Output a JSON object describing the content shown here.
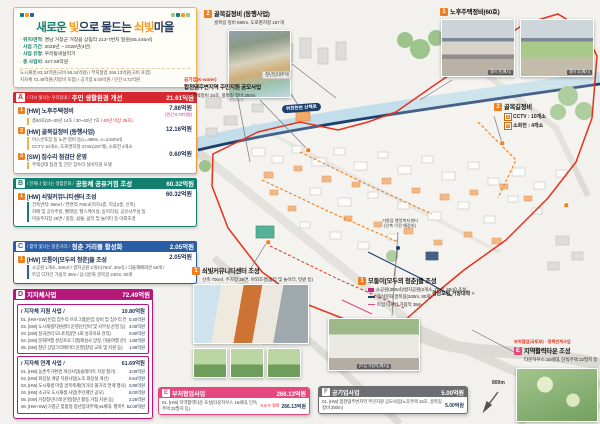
{
  "theme": {
    "accent_orange": "#f07f1e",
    "alert_red": "#e8301a",
    "teal": "#13806f",
    "blue": "#2b5ea7",
    "magenta": "#b5177a",
    "pink": "#e5477e",
    "navy": "#1d2f50",
    "gray": "#6d6e71",
    "river_blue": "#c2deea"
  },
  "title_box": {
    "title_parts": {
      "p1": "새로운 ",
      "p2": "빛",
      "p3": "으로 물드는 ",
      "p4": "쇠빛",
      "p5": "마을"
    },
    "info": [
      {
        "label": "위치/면적",
        "value": ": 경남 거창군 거창읍 상림리 213-7번지 일원(65,445㎡)"
      },
      {
        "label": "사업 기간",
        "value": ": 2025년 ~ 2028년(4년)"
      },
      {
        "label": "사업 유형",
        "value": ": 우리동네살리기"
      },
      {
        "label": "총 사업비",
        "value": ": 427.68억원"
      }
    ],
    "note1": "도시재생 83.34억원(국비 58.34억원) / 부처협업 266.13억원(국비 포함)",
    "note2": "지자체 72.49억원(지방비 포함) / 공기업 5.00억원 / 민간 0.72억원"
  },
  "sections": {
    "A": {
      "badge": "A",
      "tagline": "/ 다시 빛나는 우리동네 /",
      "title": "주민 생활환경 개선",
      "total": "21.61억원",
      "items": [
        {
          "no": "1",
          "title": "[HW] 노후주택정비",
          "amount": "7.86억원",
          "amount_sub": "(민간 0.72억원)",
          "detail_pre": "총60호(20~30년 14호 / 30~40년 7호 / ",
          "detail_red": "40년 이상 39호)"
        },
        {
          "no": "2",
          "title": "[HW] 골목길정비 (동행사업)",
          "amount": "12.16억원",
          "details": [
            "아스콘포장 등 노면 정비 등(L=498m, A=2,840㎡)",
            "CCTV 10개소, 도로명지정 374m(187개), 소화전 4개소"
          ]
        },
        {
          "no": "3",
          "title": "[SW] 집수리 점검단 운영",
          "amount": "0.60억원",
          "details": [
            "주택상태 점검 및 간단 집수리 실비지원 모델"
          ]
        }
      ]
    },
    "B": {
      "badge": "B",
      "tagline": "/ 언제나 빛나는 생활문화 /",
      "title": "공동체 공유거점 조성",
      "total": "60.32억원",
      "items": [
        {
          "no": "1",
          "title": "[HW] 쇠빛커뮤니티센터 조성",
          "amount": "60.32억원",
          "details": [
            "건축면적: 950㎡ / 연면적 700㎡(지하1층, 지상2층, 신축)",
            "카페 및 공유주방, 빨래방, 헬스케어실, 동아리실, 공유사무실 등",
            "마을주차장 25면 / 중정, 쉼뜰, 쉼터 및 놀이터 등 야외조경"
          ]
        }
      ]
    },
    "C": {
      "badge": "C",
      "tagline": "/ 활력 빛나는 청춘거리 /",
      "title": "청춘 거리뜰 활성화",
      "total": "2.05억원",
      "items": [
        {
          "no": "1",
          "title": "[HW] 모퉁이[모두의 청춘]뜰 조성",
          "amount": "2.05억원",
          "details": [
            "소공원 1개소, 300㎡ / 쌈지공원 2개소(78㎡, 30㎡) / 식물재배화분 68개 /",
            "트임 디자인 가림막 38m / 음식문화 골목길 240m, 80개"
          ]
        }
      ]
    },
    "D": {
      "badge": "D",
      "title": "지자체사업",
      "total": "72.49억원",
      "groups": [
        {
          "name": "/ 지자체 지원 사업 /",
          "total": "10.80억원",
          "items": [
            {
              "no": "01.",
              "title": "[HW+SW] 빈집 집수리 프로그램(빈집 정비 및 집수리 연계 등)",
              "amount": "0.40억원"
            },
            {
              "no": "02.",
              "title": "[SW] 도시재생지원센터 운영(인건비 및 사무실 운영 등)",
              "amount": "4.00억원"
            },
            {
              "no": "03.",
              "title": "[SW] 성과관리 모니터링(연 1회 성과지표 관리)",
              "amount": "0.80억원"
            },
            {
              "no": "04.",
              "title": "[SW] 문화여행 성장프로그램(해설사 양성, 마을여행 운영 등)",
              "amount": "1.80억원"
            },
            {
              "no": "05.",
              "title": "[SW] 청년 상업크리에이터 운영(창업 교육 및 지원 등)",
              "amount": "1.80억원"
            }
          ]
        },
        {
          "name": "/ 지자체 연계 사업 /",
          "total": "61.69억원",
          "items": [
            {
              "no": "01.",
              "title": "[HW] 농촌주거환경 개선사업(슬레이트 지붕 철거)",
              "amount": "3.00억원"
            },
            {
              "no": "02.",
              "title": "[HW] 화장실 개량 지원사업(노후 화장실 개선)",
              "amount": "0.64억원"
            },
            {
              "no": "03.",
              "title": "[HW] 도시재생 마중 골목축제(먹거리·볼거리 연계 행사)",
              "amount": "0.80억원"
            },
            {
              "no": "04.",
              "title": "[HW] 소규모 도시재생 사업(주민제안 공모)",
              "amount": "8.00억원"
            },
            {
              "no": "05.",
              "title": "[SW] 거창청년나래 운영(청년 활동 거점 지원 등)",
              "amount": "3.25억원"
            },
            {
              "no": "06.",
              "title": "[HW+SW] 거창군 맞춤형 청년임대주택(44세대, 행복주택 연계)",
              "amount": "52.00억원"
            }
          ]
        }
      ]
    },
    "E": {
      "badge": "E",
      "title": "부처협업사업",
      "total": "266.13억원",
      "items": [
        {
          "no": "01.",
          "title": "[HW] 지역활력타운 조성(타운하우스 16세대, 단독주택 32필지 등)",
          "stamp": "국토부 협업",
          "amount": "266.13억원"
        }
      ]
    },
    "F": {
      "badge": "F",
      "title": "공기업사업",
      "total": "5.00억원",
      "items": [
        {
          "no": "01.",
          "title": "[HW] 합천댐주변지역 주민지원 공모사업(노후주택 15호, 골목길 정비 250m)",
          "amount": "5.00억원"
        }
      ]
    }
  },
  "map": {
    "callouts": {
      "alley_top": {
        "no": "2",
        "title": "골목길정비 (동행사업)",
        "subtitle": "골목길 정비 590m, 도로명지정 187개"
      },
      "housing_top": {
        "no": "1",
        "title": "노후주택정비(60호)",
        "photo_before": "정비 전(예시)",
        "photo_after": "정비 후(예시)"
      },
      "alley_right": {
        "no": "2",
        "title": "골목길정비",
        "rows": [
          {
            "icon": "cctv",
            "text": "CCTV : 10개소"
          },
          {
            "icon": "hydrant",
            "text": "소화전 : 4개소"
          }
        ]
      },
      "kwater": {
        "tag": "공기업(K-water)",
        "title": "합천댐주변지역 주민지원 공모사업",
        "subtitle": "노후주택정비 15호, 골목길 정비 250m"
      },
      "community": {
        "no": "1",
        "title": "쇠빛커뮤니티센터 조성",
        "subtitle": "신축 700㎡, 주차장 25면, 야외조경(쉼터 및 놀이터, 텃밭 등)"
      },
      "motungi": {
        "no": "1",
        "title": "모퉁이[모두의 청춘]뜰 조성",
        "legend": [
          {
            "text": "소공원(300㎡)/쌈지공원(2개소, 78㎡, 30㎡) 조성"
          },
          {
            "text": "음식문화 골목길(240m, 80개)"
          },
          {
            "text": "트임 디자인 가림막 38m"
          }
        ],
        "photo_caption": "[트임 가림막(예시)]"
      },
      "vitality": {
        "tag": "부처협업(국토부) · 정책연계사업",
        "badge": "E",
        "title": "지역활력타운 조성",
        "subtitle": "타운하우스 16세대, 단독주택 32필지 등"
      }
    },
    "labels": {
      "river_walk": "위천천변 산책로",
      "youth_housing": "청년임대주택",
      "admin_center_1": "거창읍 행정복지센터",
      "admin_center_2": "(신축 이전 예정지)",
      "college": "경남도립 거창대학",
      "college_marker": "+",
      "scale": "800m"
    }
  }
}
